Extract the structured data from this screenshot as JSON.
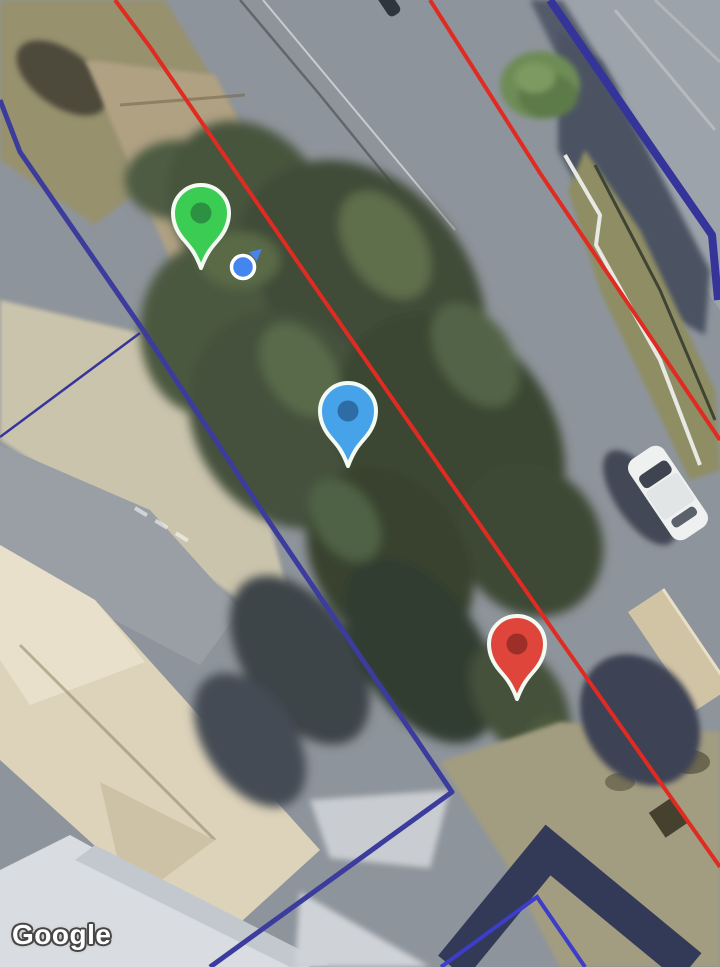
{
  "map": {
    "attribution": "Google"
  },
  "markers": {
    "green_pin": {
      "transform": "translate(201 268)",
      "fill": "#3bcd53",
      "dot": "#2c9140"
    },
    "blue_pin": {
      "transform": "translate(348 466)",
      "fill": "#46a2e9",
      "dot": "#2d6ca5"
    },
    "red_pin": {
      "transform": "translate(517 699)",
      "fill": "#e0453b",
      "dot": "#9e2e28"
    },
    "location_dot": {
      "transform": "translate(243 267)",
      "fill": "#4485ee"
    }
  },
  "overlays": {
    "red_main": {
      "points": "115,0 150,47 310,280 560,640 720,867",
      "color": "#e02b22",
      "width": "4"
    },
    "red_right": {
      "points": "430,0 540,173 720,440",
      "color": "#e02b22",
      "width": "4"
    },
    "parcel_left": {
      "points": "0,100 20,152 143,330 268,520 452,792 210,967",
      "color": "#3c3c9d",
      "width": "5"
    },
    "parcel_branch": {
      "points": "140,333 0,437",
      "color": "#35359a",
      "width": "2.5"
    },
    "parcel_right": {
      "points": "550,0 660,160 712,235 718,300",
      "color": "#34349a",
      "width": "8"
    },
    "parcel_bottom": {
      "points": "441,967 537,897 585,967",
      "color": "#3d3dc9",
      "width": "4"
    }
  }
}
